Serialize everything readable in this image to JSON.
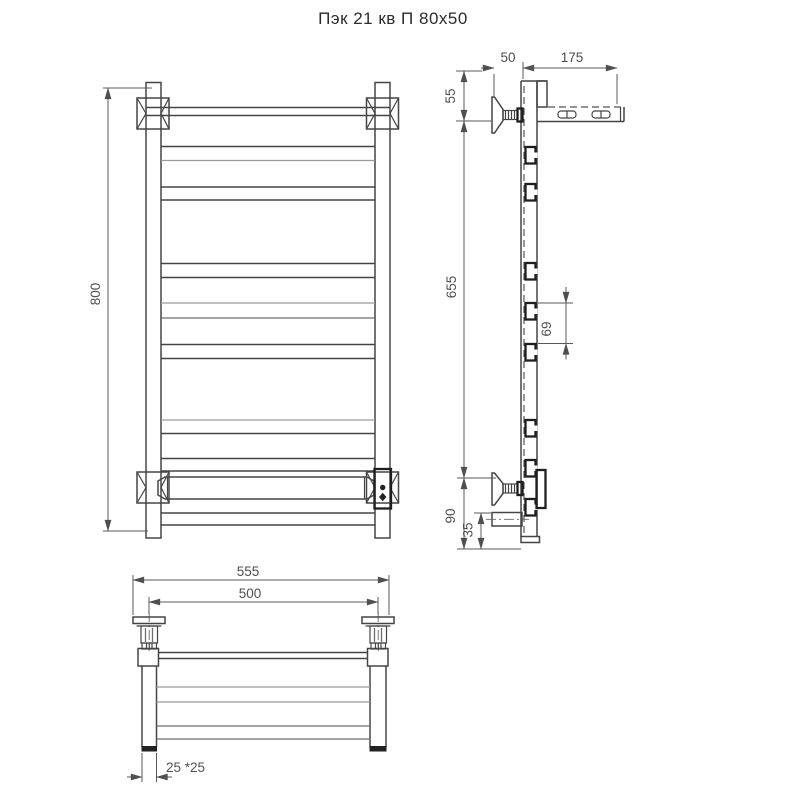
{
  "title": "Пэк 21 кв П 80х50",
  "drawing": {
    "type": "technical-drawing-3-views",
    "views": [
      "front-view",
      "side-view",
      "top-view"
    ],
    "line_color": "#454545",
    "light_line_color": "#9a9a9a",
    "dim_color": "#4f4f4f",
    "background": "#ffffff"
  },
  "dimensions": {
    "front_height": "800",
    "side_wall_offset": "50",
    "side_shelf_depth": "175",
    "side_top_offset": "55",
    "side_mount_span": "655",
    "side_rung_gap": "69",
    "side_bottom_offset": "90",
    "side_element_offset": "35",
    "top_overall_width": "555",
    "top_mount_spacing": "500",
    "top_profile": "25 *25"
  }
}
